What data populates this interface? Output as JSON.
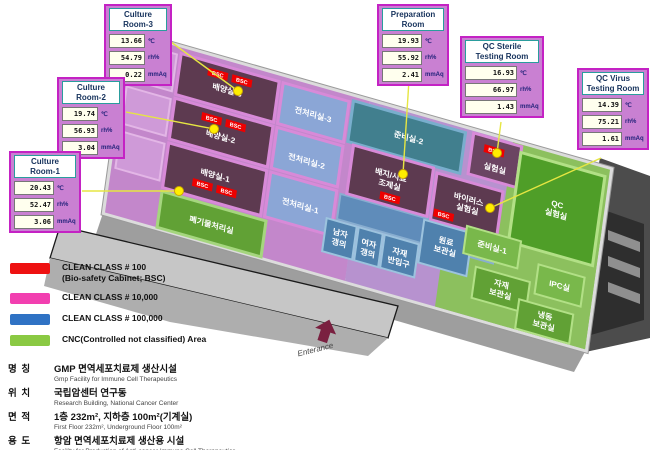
{
  "callouts": [
    {
      "title": "Culture\nRoom-3",
      "temp": "13.66",
      "rh": "54.79",
      "mmaq": "0.22"
    },
    {
      "title": "Culture\nRoom-2",
      "temp": "19.74",
      "rh": "56.93",
      "mmaq": "3.04"
    },
    {
      "title": "Culture\nRoom-1",
      "temp": "20.43",
      "rh": "52.47",
      "mmaq": "3.06"
    },
    {
      "title": "Preparation\nRoom",
      "temp": "19.93",
      "rh": "55.92",
      "mmaq": "2.41"
    },
    {
      "title": "QC Sterile\nTesting Room",
      "temp": "16.93",
      "rh": "66.97",
      "mmaq": "1.43"
    },
    {
      "title": "QC Virus\nTesting Room",
      "temp": "14.39",
      "rh": "75.21",
      "mmaq": "1.61"
    }
  ],
  "units": {
    "temp": "℃",
    "humidity": "rh%",
    "pressure": "mmAq"
  },
  "bsc_tag": "BSC",
  "entrance": {
    "label": "Enterance"
  },
  "legend": {
    "items": [
      {
        "color": "#ee1111",
        "label": "CLEAN CLASS # 100",
        "sublabel": "(Bio-safety Cabinet; BSC)"
      },
      {
        "color": "#f23fb0",
        "label": "CLEAN CLASS # 10,000",
        "sublabel": ""
      },
      {
        "color": "#2f72c4",
        "label": "CLEAN CLASS # 100,000",
        "sublabel": ""
      },
      {
        "color": "#8ac943",
        "label": "CNC(Controlled not classified) Area",
        "sublabel": ""
      }
    ]
  },
  "rooms": [
    {
      "label": "배양실-3"
    },
    {
      "label": "전처리실-3"
    },
    {
      "label": "배양실-2"
    },
    {
      "label": "전처리실-2"
    },
    {
      "label": "배양실-1"
    },
    {
      "label": "전처리실-1"
    },
    {
      "label": "준비실-2"
    },
    {
      "label": "배지/시료",
      "label2": "조제실"
    },
    {
      "label": "실험실"
    },
    {
      "label": "바이러스",
      "label2": "실험실"
    },
    {
      "label": "폐기물처리실"
    },
    {
      "label": "남자",
      "label2": "갱의"
    },
    {
      "label": "여자",
      "label2": "갱의"
    },
    {
      "label": "자재",
      "label2": "반입구"
    },
    {
      "label": "원료",
      "label2": "보관실"
    },
    {
      "label": "QC",
      "label2": "실험실"
    },
    {
      "label": "준비실-1"
    },
    {
      "label": "자재",
      "label2": "보관실"
    },
    {
      "label": "IPC실"
    },
    {
      "label": "냉동",
      "label2": "보관실"
    }
  ],
  "info": {
    "rows": [
      {
        "key": "명 칭",
        "ko": "GMP 면역세포치료제 생산시설",
        "en": "Gmp Facility for Immune Cell Therapeutics"
      },
      {
        "key": "위 치",
        "ko": "국립암센터 연구동",
        "en": "Research Building, National Cancer Center"
      },
      {
        "key": "면 적",
        "ko": "1층 232m², 지하층 100m²(기계실)",
        "en": "First Floor 232m², Underground Floor 100m²"
      },
      {
        "key": "용 도",
        "ko": "항암 면역세포치료제 생산용 시설",
        "en": "Facility for Production of Anti-cancer Immune Cell Therapeutics"
      }
    ]
  },
  "colors": {
    "callout_border": "#c422c4",
    "callout_fill": "#c980d2",
    "class_100": "#ee1111",
    "class_10000": "#f23fb0",
    "class_100000": "#2f72c4",
    "cnc": "#8ac943",
    "leader_line": "#e6e642",
    "leader_dot": "#ffee00",
    "entrance_arrow": "#7a2040"
  }
}
